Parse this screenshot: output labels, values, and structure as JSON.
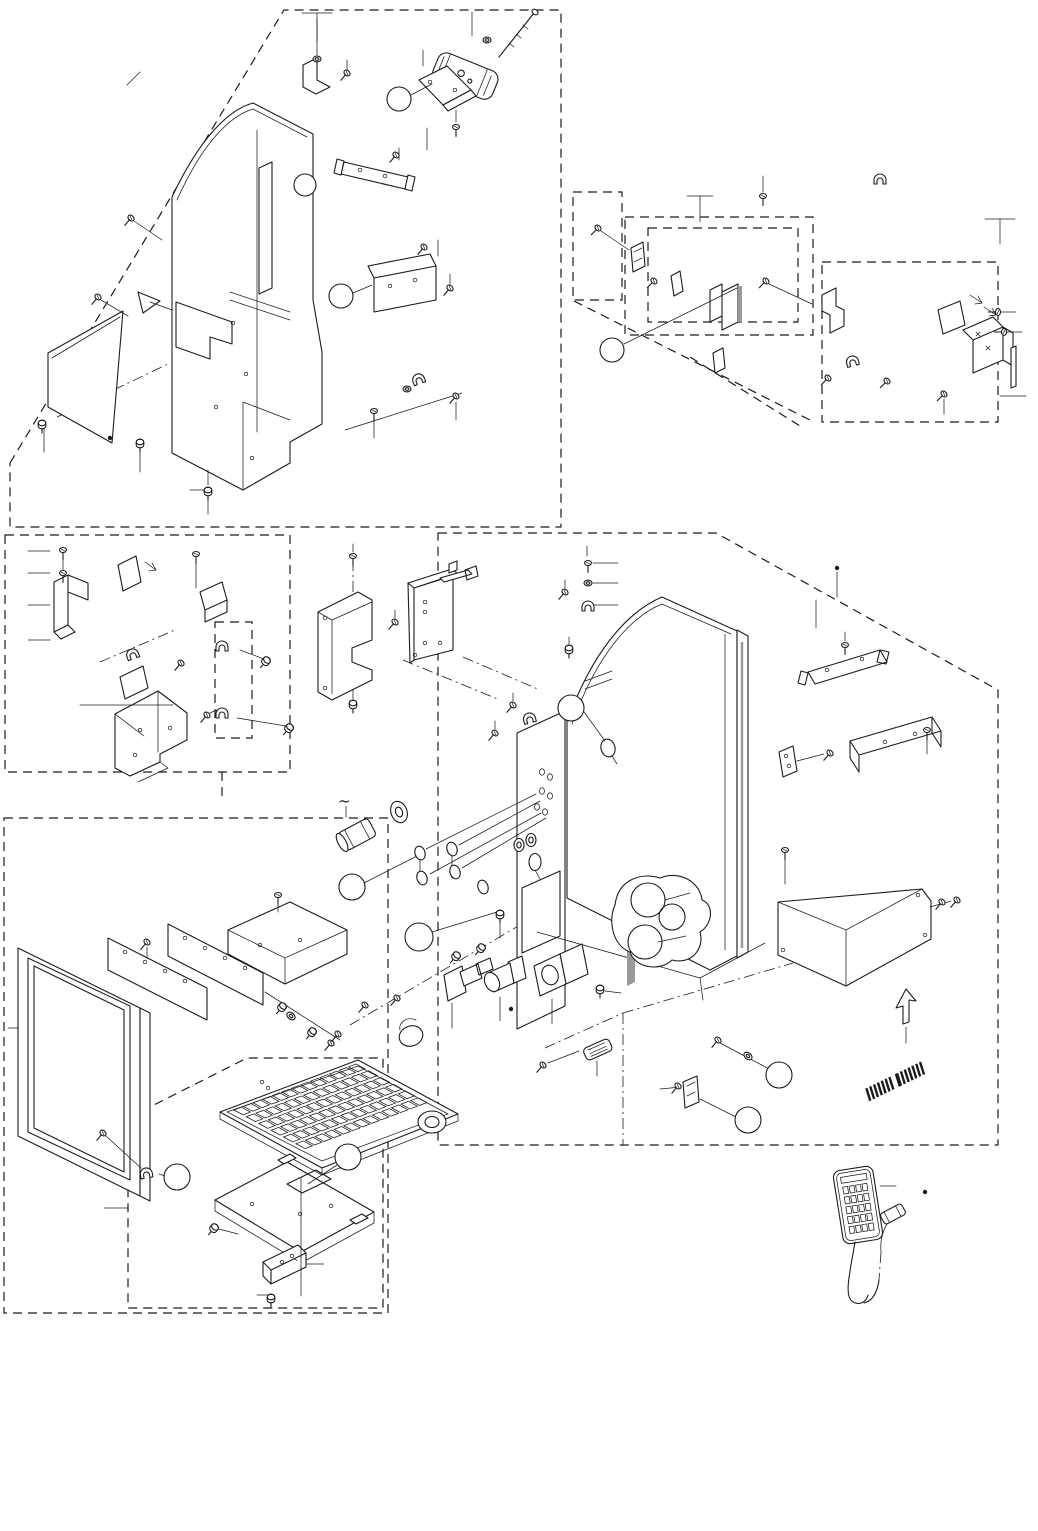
{
  "page": {
    "bg": "#ffffff",
    "ink": "#1c1c1c",
    "shade": "#9a9a9a"
  },
  "symbols": {
    "ac_power": "~"
  },
  "callouts": [
    {
      "x": 399,
      "y": 99,
      "r": 12
    },
    {
      "x": 305,
      "y": 185,
      "r": 11
    },
    {
      "x": 341,
      "y": 296,
      "r": 12
    },
    {
      "x": 612,
      "y": 350,
      "r": 12
    },
    {
      "x": 571,
      "y": 708,
      "r": 13
    },
    {
      "x": 352,
      "y": 887,
      "r": 13
    },
    {
      "x": 419,
      "y": 937,
      "r": 14
    },
    {
      "x": 779,
      "y": 1075,
      "r": 13
    },
    {
      "x": 748,
      "y": 1120,
      "r": 13
    },
    {
      "x": 177,
      "y": 1177,
      "r": 13
    },
    {
      "x": 348,
      "y": 1157,
      "r": 13
    }
  ],
  "fasteners": {
    "screws": [
      [
        131,
        218,
        40,
        "s"
      ],
      [
        98,
        297,
        40,
        "s"
      ],
      [
        42,
        423,
        0,
        "b"
      ],
      [
        140,
        442,
        0,
        "b"
      ],
      [
        208,
        490,
        0,
        "b"
      ],
      [
        347,
        73,
        40,
        "s"
      ],
      [
        317,
        59,
        0,
        "n"
      ],
      [
        487,
        40,
        0,
        "n"
      ],
      [
        456,
        127,
        0,
        "s"
      ],
      [
        396,
        155,
        40,
        "s"
      ],
      [
        424,
        247,
        40,
        "s"
      ],
      [
        450,
        288,
        40,
        "s"
      ],
      [
        407,
        389,
        0,
        "n"
      ],
      [
        456,
        396,
        40,
        "s"
      ],
      [
        374,
        411,
        0,
        "s"
      ],
      [
        598,
        228,
        45,
        "s"
      ],
      [
        654,
        281,
        45,
        "s"
      ],
      [
        766,
        281,
        45,
        "s"
      ],
      [
        763,
        196,
        0,
        "s"
      ],
      [
        828,
        378,
        45,
        "s"
      ],
      [
        887,
        381,
        45,
        "s"
      ],
      [
        944,
        394,
        45,
        "s"
      ],
      [
        998,
        312,
        90,
        "s"
      ],
      [
        1004,
        332,
        90,
        "s"
      ],
      [
        63,
        550,
        0,
        "s"
      ],
      [
        63,
        573,
        0,
        "s"
      ],
      [
        196,
        554,
        0,
        "s"
      ],
      [
        181,
        663,
        40,
        "s"
      ],
      [
        267,
        660,
        40,
        "b"
      ],
      [
        290,
        727,
        40,
        "b"
      ],
      [
        207,
        715,
        40,
        "s"
      ],
      [
        353,
        556,
        0,
        "s"
      ],
      [
        395,
        622,
        40,
        "s"
      ],
      [
        353,
        703,
        0,
        "b"
      ],
      [
        513,
        705,
        40,
        "s"
      ],
      [
        495,
        733,
        40,
        "s"
      ],
      [
        569,
        648,
        0,
        "b"
      ],
      [
        565,
        592,
        40,
        "s"
      ],
      [
        588,
        563,
        0,
        "s"
      ],
      [
        588,
        583,
        0,
        "n"
      ],
      [
        845,
        645,
        0,
        "s"
      ],
      [
        927,
        730,
        0,
        "s"
      ],
      [
        830,
        753,
        40,
        "s"
      ],
      [
        785,
        850,
        0,
        "s"
      ],
      [
        942,
        902,
        40,
        "s"
      ],
      [
        957,
        900,
        40,
        "s"
      ],
      [
        500,
        913,
        0,
        "b"
      ],
      [
        457,
        955,
        40,
        "b"
      ],
      [
        482,
        947,
        40,
        "b"
      ],
      [
        600,
        988,
        0,
        "b"
      ],
      [
        543,
        1065,
        40,
        "s"
      ],
      [
        678,
        1086,
        40,
        "s"
      ],
      [
        718,
        1040,
        40,
        "s"
      ],
      [
        748,
        1056,
        40,
        "w"
      ],
      [
        147,
        942,
        40,
        "s"
      ],
      [
        278,
        895,
        0,
        "s"
      ],
      [
        283,
        1006,
        40,
        "b"
      ],
      [
        291,
        1016,
        40,
        "w"
      ],
      [
        313,
        1031,
        40,
        "b"
      ],
      [
        331,
        1043,
        40,
        "s"
      ],
      [
        338,
        1034,
        40,
        "s"
      ],
      [
        365,
        1005,
        40,
        "s"
      ],
      [
        397,
        998,
        40,
        "s"
      ],
      [
        103,
        1133,
        40,
        "s"
      ],
      [
        215,
        1227,
        40,
        "b"
      ],
      [
        271,
        1297,
        0,
        "b"
      ]
    ],
    "clamps": [
      [
        418,
        378,
        -20
      ],
      [
        852,
        360,
        -15
      ],
      [
        588,
        605,
        0
      ],
      [
        529,
        717,
        -15
      ],
      [
        132,
        653,
        -20
      ],
      [
        222,
        645,
        0
      ],
      [
        222,
        712,
        0
      ],
      [
        146,
        1172,
        -10
      ],
      [
        880,
        178,
        0
      ]
    ],
    "grommets": [
      [
        519,
        845
      ],
      [
        531,
        840
      ]
    ]
  },
  "ovals": [
    [
      420,
      853
    ],
    [
      452,
      849
    ],
    [
      422,
      878
    ],
    [
      455,
      872
    ],
    [
      483,
      887
    ]
  ],
  "panel_holes": [
    [
      125,
      952
    ],
    [
      145,
      962
    ],
    [
      165,
      971
    ],
    [
      185,
      981
    ],
    [
      185,
      938
    ],
    [
      205,
      948
    ],
    [
      225,
      958
    ],
    [
      245,
      968
    ],
    [
      246,
      374
    ],
    [
      216,
      407
    ],
    [
      252,
      458
    ],
    [
      233,
      323
    ],
    [
      140,
      730
    ],
    [
      170,
      728
    ],
    [
      135,
      755
    ],
    [
      425,
      602
    ],
    [
      425,
      612
    ],
    [
      440,
      643
    ],
    [
      425,
      643
    ],
    [
      415,
      655
    ],
    [
      325,
      618
    ],
    [
      325,
      688
    ],
    [
      360,
      170
    ],
    [
      385,
      176
    ],
    [
      390,
      286
    ],
    [
      415,
      280
    ],
    [
      430,
      82
    ],
    [
      455,
      90
    ],
    [
      827,
      670
    ],
    [
      862,
      659
    ],
    [
      885,
      742
    ],
    [
      915,
      734
    ],
    [
      786,
      756
    ],
    [
      789,
      766
    ],
    [
      918,
      895
    ],
    [
      925,
      935
    ],
    [
      783,
      950
    ],
    [
      300,
      940
    ],
    [
      260,
      945
    ],
    [
      282,
      1262
    ],
    [
      292,
      1256
    ],
    [
      252,
      1204
    ],
    [
      331,
      1206
    ],
    [
      300,
      1214
    ],
    [
      262,
      1082
    ],
    [
      268,
      1088
    ]
  ],
  "chassis_holes": [
    [
      542,
      772
    ],
    [
      550,
      777
    ],
    [
      542,
      791
    ],
    [
      550,
      796
    ],
    [
      537,
      807
    ],
    [
      545,
      812
    ]
  ],
  "dots": [
    [
      925,
      1192
    ],
    [
      837,
      568
    ],
    [
      511,
      1009
    ],
    [
      110,
      438
    ]
  ],
  "keyboard": {
    "o": [
      234,
      1110
    ],
    "u": [
      9.55,
      -3.6
    ],
    "v": [
      12.4,
      6.75
    ],
    "rows": 6,
    "cols": 13,
    "kw": 0.78,
    "kh": 0.72,
    "trackball": {
      "cx": 432,
      "cy": 1122,
      "rx": 14,
      "ry": 11,
      "irx": 7,
      "iry": 5.5
    }
  },
  "remote": {
    "cx": 858,
    "cy": 1205,
    "angle": -9,
    "w": 40,
    "h": 74,
    "key_cols": 4,
    "key_rows": 5
  },
  "label": {
    "x": 898,
    "y": 1080,
    "angle": -26,
    "stripes": 15,
    "len": 64,
    "h": 13
  }
}
